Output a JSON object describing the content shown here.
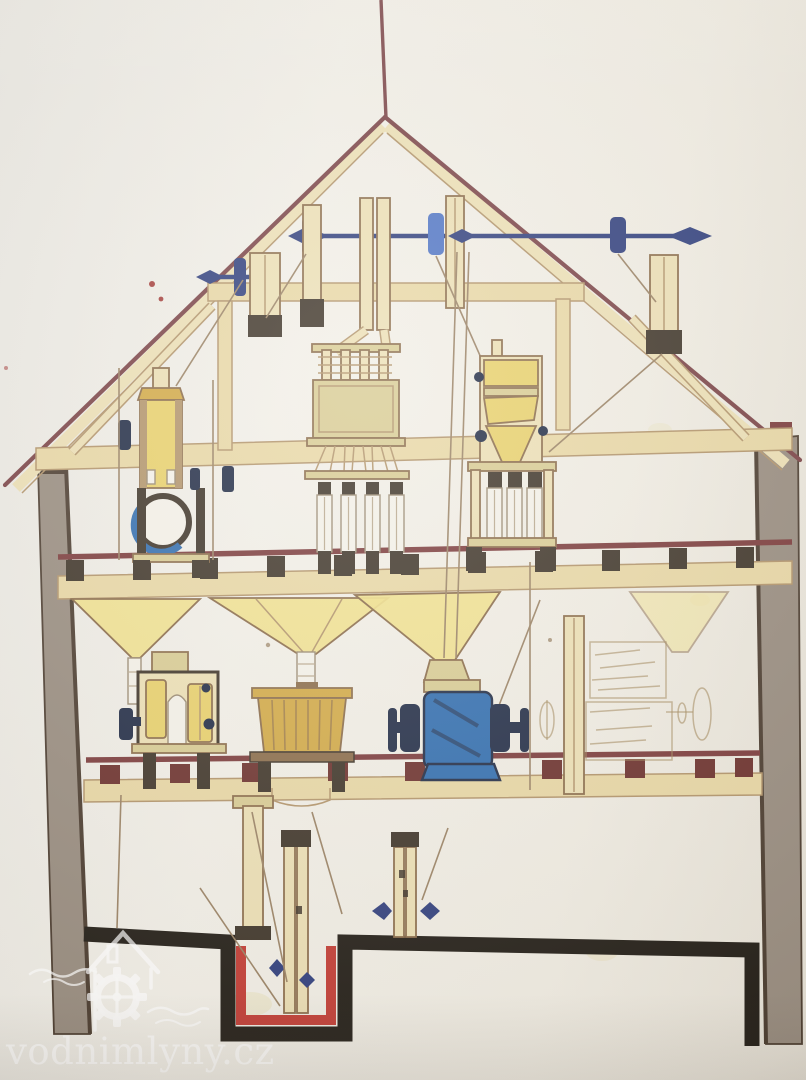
{
  "watermark": {
    "text": "vodnimlyny.cz",
    "logo": "house-and-gear-watermark"
  },
  "colors": {
    "paper": "#f0ece1",
    "roof_outline": "#7a4245",
    "beam_fill": "#e8d7a4",
    "beam_edge": "#b2946a",
    "beam_dark": "#8a6b49",
    "tube_fill": "#ecdfb4",
    "floor_red": "#7b3a3a",
    "joist_dark": "#3d3327",
    "joist_red": "#6b2f2b",
    "wall_gray": "#988c7f",
    "wall_dark": "#4a3b2e",
    "ground_black": "#211c15",
    "shaft_blue": "#2f3e7c",
    "pulley_blue_light": "#4f74c4",
    "machine_blue": "#2f6cae",
    "machine_blue_dark": "#1f2a44",
    "machine_yellow": "#e8d06a",
    "machine_gold": "#d2a945",
    "machine_khaki": "#d8cb92",
    "hopper_yellow": "#f0e08a",
    "sleeve_white": "#f4f1e8",
    "sleeve_edge": "#9a8a72",
    "sleeve_band": "#b9a98e",
    "pit_red": "#c23b33",
    "belt_brown": "#9a8264",
    "sketch_brown": "#a58a5f",
    "stain_yellow": "#d8c050",
    "speck_red": "#a5403c",
    "watermark_white": "#ffffff"
  },
  "scene": {
    "type": "hand-drawn watermill cross-section (photographed drawing)",
    "components": [
      "lightning-rod",
      "gable-roof",
      "roof-truss",
      "attic-line-shaft",
      "belt-pulleys",
      "grain-elevator-tubes",
      "plansifter",
      "purifier",
      "aspirator-fan",
      "grain-hoppers",
      "roller-mill-left",
      "millstone-vat",
      "roller-mill-blue",
      "sketched-machine",
      "support-column",
      "elevator-legs",
      "elevator-pit",
      "masonry-wall-left",
      "masonry-wall-right",
      "floor-beams",
      "ground-line",
      "watermark-logo"
    ]
  }
}
